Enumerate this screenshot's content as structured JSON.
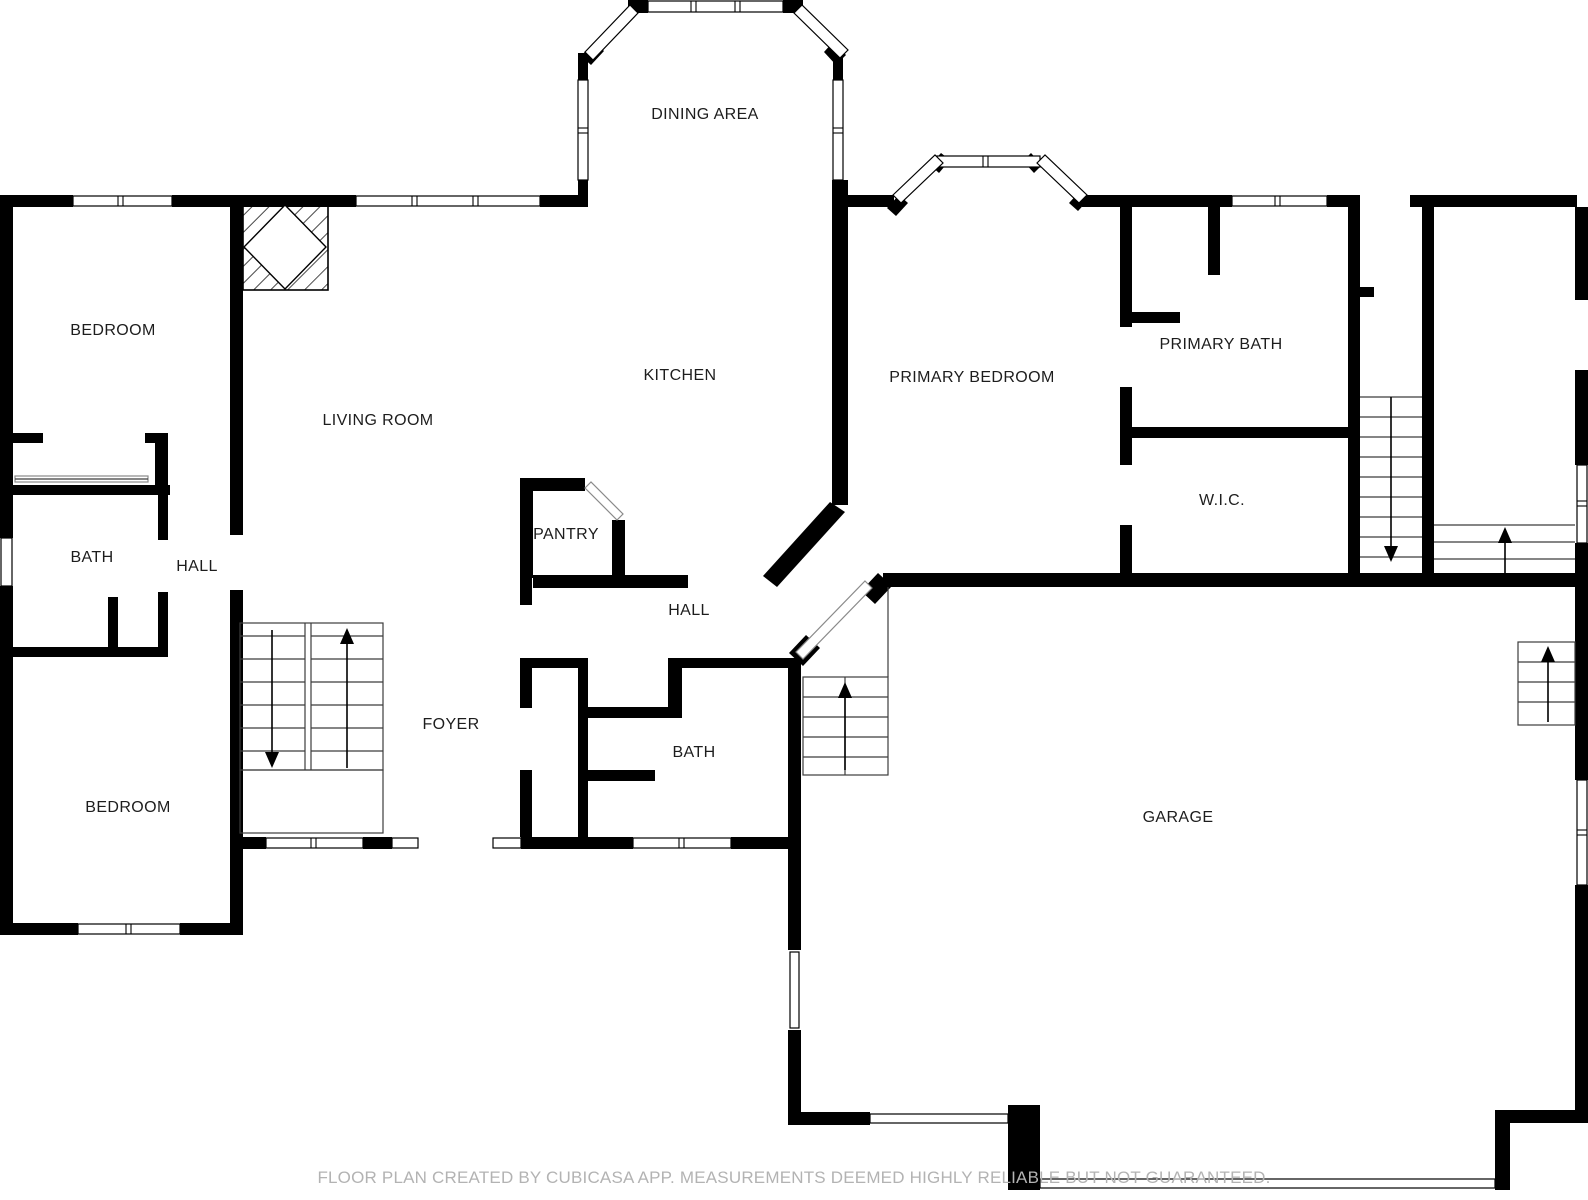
{
  "rooms": {
    "dining_area": "DINING AREA",
    "bedroom_top_left": "BEDROOM",
    "kitchen": "KITCHEN",
    "primary_bedroom": "PRIMARY BEDROOM",
    "primary_bath": "PRIMARY BATH",
    "living_room": "LIVING ROOM",
    "wic": "W.I.C.",
    "bath_left": "BATH",
    "hall_left": "HALL",
    "pantry": "PANTRY",
    "hall_center": "HALL",
    "foyer": "FOYER",
    "bath_center": "BATH",
    "bedroom_bottom_left": "BEDROOM",
    "garage": "GARAGE"
  },
  "footer": {
    "disclaimer": "FLOOR PLAN CREATED BY CUBICASA APP. MEASUREMENTS DEEMED HIGHLY RELIABLE BUT NOT GUARANTEED."
  },
  "colors": {
    "wall": "#000000",
    "background": "#ffffff",
    "label_text": "#1d1d1d",
    "footer_text": "#b3b3b3",
    "stair_line": "#3c3c3c"
  }
}
